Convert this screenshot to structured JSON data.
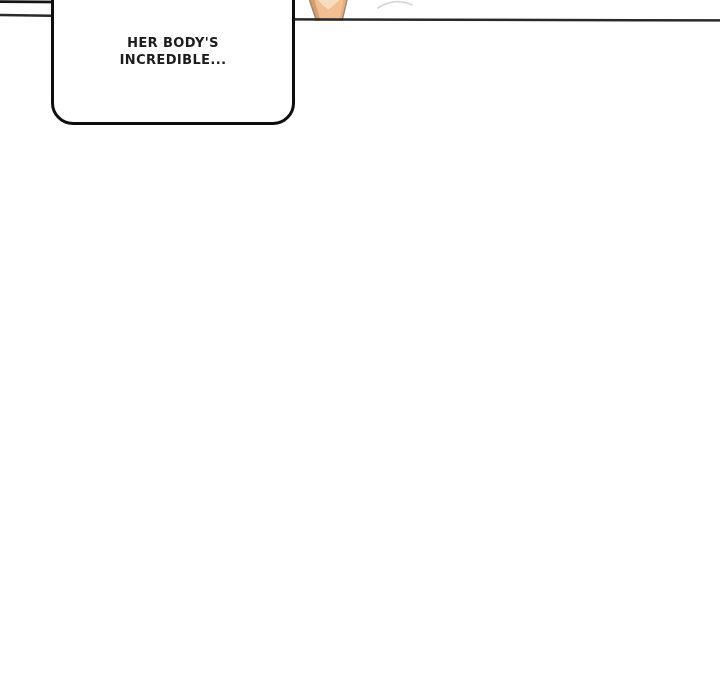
{
  "page": {
    "background": "#ffffff",
    "kind": "comic-panel-gutter"
  },
  "speech_bubble": {
    "line1": "HER BODY'S",
    "line2": "INCREDIBLE...",
    "border_color": "#0d0d0d",
    "fill": "#ffffff",
    "text_color": "#1c1c1c"
  },
  "panel": {
    "bottom_border_color": "#2a2a2a",
    "top_left_stub_color": "#151515"
  },
  "artwork": {
    "arm": {
      "fill_main": "#F2BE92",
      "fill_highlight": "#F8DCC1",
      "shade_left": "#D59E70",
      "shade_right": "#ECAF7C",
      "outline": "#96857A"
    },
    "faint_curve_color": "#D9D9D9"
  }
}
